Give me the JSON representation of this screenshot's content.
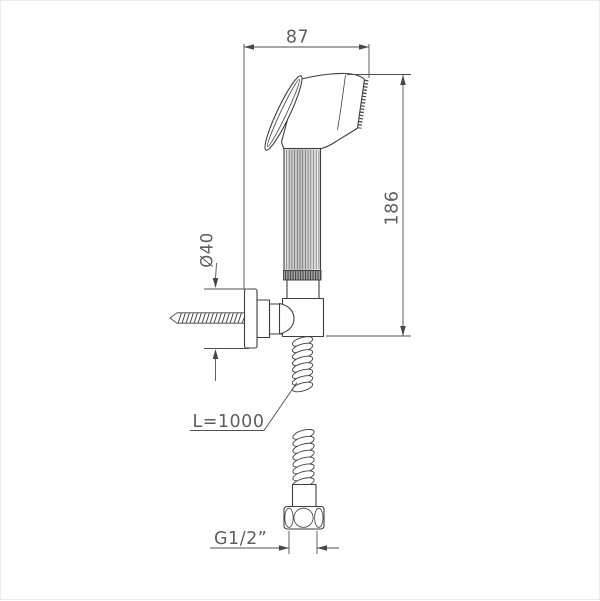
{
  "page": {
    "background": "#ffffff",
    "frame_border": "#ededed"
  },
  "drawing": {
    "colors": {
      "outline": "#3e3e3e",
      "dimension_lines": "#4f4f4f",
      "label_text": "#5f5f5f"
    },
    "labels": {
      "head_width": "87",
      "overall_height": "186",
      "flange_diameter": "Ø40",
      "hose_length": "L=1000",
      "thread": "G1/2”"
    }
  }
}
